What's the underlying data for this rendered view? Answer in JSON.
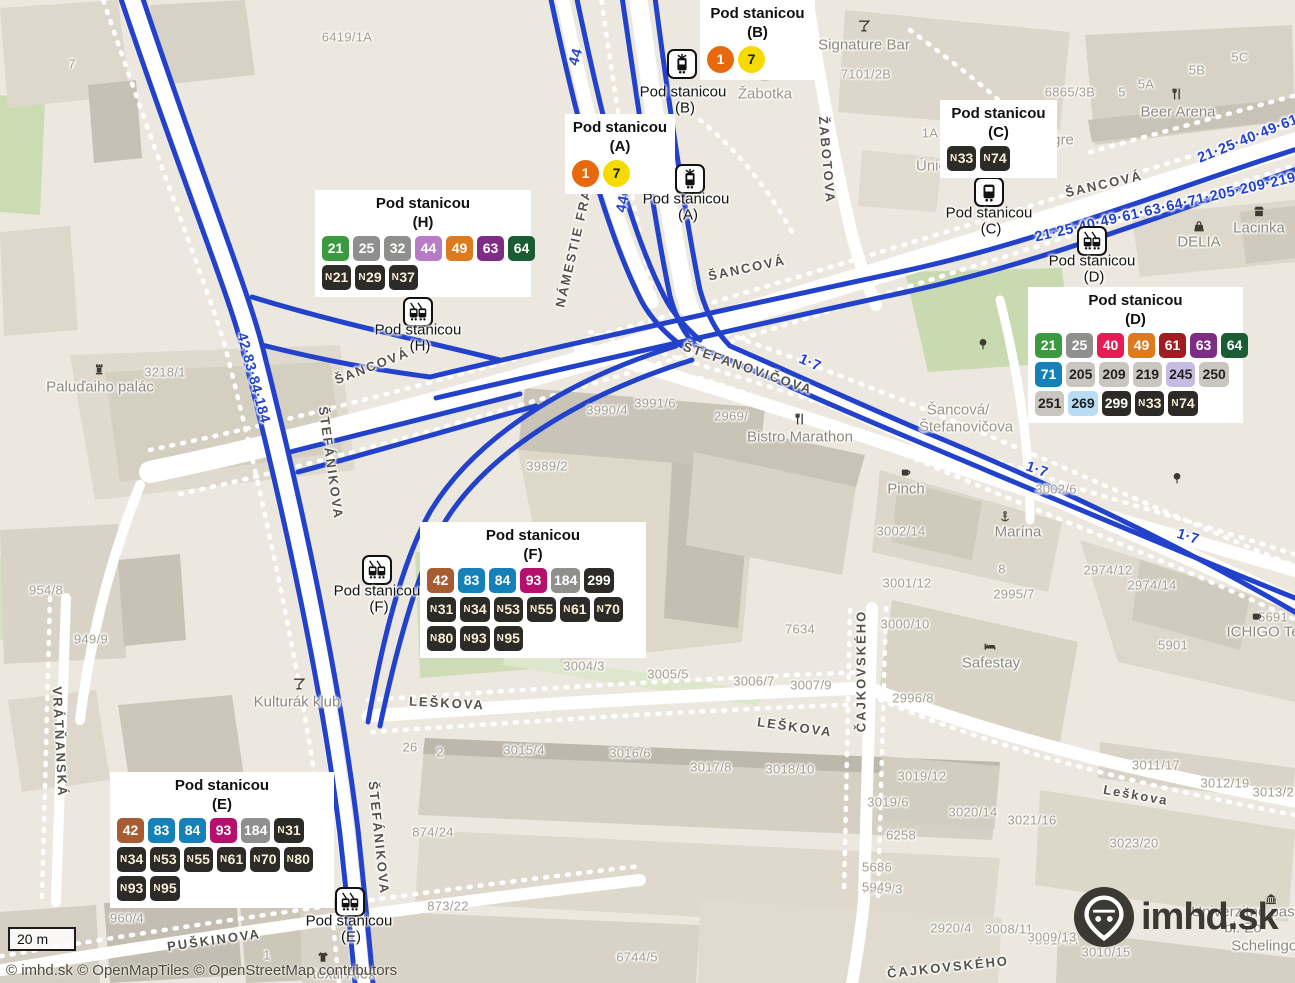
{
  "ui": {
    "scale_label": "20 m",
    "attribution": "© imhd.sk © OpenMapTiles © OpenStreetMap contributors",
    "logo_text": "imhd.sk"
  },
  "colors": {
    "route_line": "#2342cb",
    "map_bg": "#ece8df",
    "road": "#ffffff",
    "tram1": "#e8690b",
    "tram7": "#f7da00",
    "night_badge_bg": "#2c2b27",
    "night_badge_fg": "#f8eed6"
  },
  "streets": [
    [
      "ŠANCOVÁ",
      372,
      366,
      -21
    ],
    [
      "ŠANCOVÁ",
      747,
      268,
      -12
    ],
    [
      "ŠANCOVÁ",
      1104,
      184,
      -13
    ],
    [
      "ŠTEFÁNIKOVA",
      331,
      463,
      82
    ],
    [
      "ŠTEFÁNIKOVA",
      379,
      838,
      84
    ],
    [
      "ŠTEFANOVIČOVA",
      748,
      368,
      19
    ],
    [
      "NÁMESTIE FRANZA",
      577,
      232,
      -77
    ],
    [
      "ŽABOTOVA",
      827,
      160,
      85
    ],
    [
      "LEŠKOVA",
      447,
      703,
      3
    ],
    [
      "LEŠKOVA",
      795,
      727,
      8
    ],
    [
      "Leškova",
      1136,
      795,
      10
    ],
    [
      "PUŠKINOVA",
      214,
      940,
      -8
    ],
    [
      "ČAJKOVSKÉHO",
      861,
      671,
      -90
    ],
    [
      "ČAJKOVSKÉHO",
      948,
      967,
      -6
    ],
    [
      "VRÁTŇANSKÁ",
      60,
      742,
      87
    ]
  ],
  "house_numbers": [
    [
      "6419/1A",
      347,
      37
    ],
    [
      "7",
      72,
      64
    ],
    [
      "7101/2B",
      866,
      74
    ],
    [
      "6865/3B",
      1070,
      92
    ],
    [
      "1A",
      930,
      133
    ],
    [
      "5",
      1122,
      92
    ],
    [
      "5A",
      1146,
      84
    ],
    [
      "5B",
      1197,
      70
    ],
    [
      "5C",
      1240,
      57
    ],
    [
      "3218/1",
      165,
      372
    ],
    [
      "954/8",
      46,
      590
    ],
    [
      "949/9",
      91,
      639
    ],
    [
      "960/4",
      127,
      918
    ],
    [
      "3990/4",
      607,
      410
    ],
    [
      "3991/6",
      655,
      403
    ],
    [
      "3989/2",
      547,
      466
    ],
    [
      "2969/",
      731,
      416
    ],
    [
      "2995/7",
      1014,
      594
    ],
    [
      "3002/6",
      1056,
      489
    ],
    [
      "3002/14",
      901,
      531
    ],
    [
      "2974/12",
      1108,
      570
    ],
    [
      "2974/14",
      1152,
      585
    ],
    [
      "3001/12",
      907,
      583
    ],
    [
      "3000/10",
      905,
      624
    ],
    [
      "2996/8",
      913,
      698
    ],
    [
      "5901",
      1173,
      645
    ],
    [
      "8",
      1002,
      569
    ],
    [
      "5691",
      1273,
      617
    ],
    [
      "7634",
      800,
      629
    ],
    [
      "3004/3",
      584,
      666
    ],
    [
      "3005/5",
      668,
      674
    ],
    [
      "3006/7",
      754,
      681
    ],
    [
      "3007/9",
      811,
      685
    ],
    [
      "26",
      410,
      747
    ],
    [
      "2",
      440,
      752
    ],
    [
      "3015/4",
      524,
      750
    ],
    [
      "3016/6",
      630,
      753
    ],
    [
      "3017/8",
      711,
      767
    ],
    [
      "3018/10",
      790,
      769
    ],
    [
      "874/24",
      433,
      832
    ],
    [
      "873/22",
      448,
      906
    ],
    [
      "1",
      267,
      955
    ],
    [
      "7864/3",
      882,
      889
    ],
    [
      "2920/4",
      951,
      928
    ],
    [
      "7501/4A",
      1053,
      940
    ],
    [
      "6744/5",
      637,
      957
    ],
    [
      "6258",
      901,
      835
    ],
    [
      "5686",
      877,
      867
    ],
    [
      "5949",
      877,
      887
    ],
    [
      "3019/12",
      922,
      776
    ],
    [
      "3019/6",
      888,
      802
    ],
    [
      "3020/14",
      973,
      812
    ],
    [
      "3021/16",
      1032,
      820
    ],
    [
      "3023/20",
      1134,
      843
    ],
    [
      "3008/11",
      1009,
      929
    ],
    [
      "3009/13",
      1052,
      937
    ],
    [
      "3010/15",
      1106,
      952
    ],
    [
      "3011/17",
      1156,
      765
    ],
    [
      "3012/19",
      1225,
      783
    ],
    [
      "3013/21",
      1277,
      792
    ]
  ],
  "pois": [
    {
      "t": "Signature Bar",
      "x": 864,
      "y": 45,
      "icon": "cocktail-icon",
      "ix": 864,
      "iy": 28
    },
    {
      "t": "Žabotka",
      "x": 765,
      "y": 94,
      "icon": "shop-icon",
      "ix": 765,
      "iy": 77
    },
    {
      "t": "Beer Arena",
      "x": 1178,
      "y": 112,
      "icon": "restaurant-icon",
      "ix": 1177,
      "iy": 96
    },
    {
      "t": "DELIA",
      "x": 1199,
      "y": 242,
      "icon": "bag-icon",
      "ix": 1199,
      "iy": 228
    },
    {
      "t": "Lacinka",
      "x": 1259,
      "y": 228,
      "icon": "shop-icon",
      "ix": 1259,
      "iy": 213
    },
    {
      "t": "Bistro Marathon",
      "x": 800,
      "y": 437,
      "icon": "restaurant-icon",
      "ix": 800,
      "iy": 421
    },
    {
      "t": "Pinch",
      "x": 906,
      "y": 489,
      "icon": "cafe-icon",
      "ix": 906,
      "iy": 474
    },
    {
      "t": "Marína",
      "x": 1018,
      "y": 532,
      "icon": "anchor-icon",
      "ix": 1005,
      "iy": 519
    },
    {
      "t": "Safestay",
      "x": 991,
      "y": 663,
      "icon": "bed-icon",
      "ix": 990,
      "iy": 648
    },
    {
      "t": "ICHIGO Te",
      "x": 1263,
      "y": 632,
      "icon": "cafe-icon",
      "ix": 1257,
      "iy": 618
    },
    {
      "t": "Kulturák klub",
      "x": 297,
      "y": 702,
      "icon": "cocktail-icon",
      "ix": 299,
      "iy": 686
    },
    {
      "t": "Paluďaiho palác",
      "x": 100,
      "y": 387,
      "icon": "monument-icon",
      "ix": 99,
      "iy": 371
    },
    {
      "t": "textil Alex",
      "x": 344,
      "y": 974,
      "icon": "clothes-icon",
      "ix": 323,
      "iy": 959
    },
    {
      "t": "Univerzitné past",
      "x": 1245,
      "y": 912,
      "icon": null,
      "ix": 0,
      "iy": 0
    },
    {
      "t": "bl. Zo",
      "x": 1243,
      "y": 928,
      "icon": null,
      "ix": 0,
      "iy": 0
    },
    {
      "t": "Schelingov",
      "x": 1268,
      "y": 946,
      "icon": null,
      "ix": 0,
      "iy": 0
    },
    {
      "t": "gre",
      "x": 1063,
      "y": 140,
      "icon": null,
      "ix": 0,
      "iy": 0
    },
    {
      "t": "Únic",
      "x": 931,
      "y": 166,
      "icon": null,
      "ix": 0,
      "iy": 0
    },
    {
      "t": "Šancová/",
      "x": 958,
      "y": 410,
      "icon": null,
      "ix": 0,
      "iy": 0
    },
    {
      "t": "Štefanovičova",
      "x": 966,
      "y": 427,
      "icon": null,
      "ix": 0,
      "iy": 0
    },
    {
      "t": "",
      "x": 1271,
      "y": 901,
      "icon": "museum-icon",
      "ix": 1271,
      "iy": 901
    },
    {
      "t": "",
      "x": 983,
      "y": 346,
      "icon": "tree-icon",
      "ix": 983,
      "iy": 346
    },
    {
      "t": "",
      "x": 1177,
      "y": 480,
      "icon": "tree-icon",
      "ix": 1177,
      "iy": 480
    }
  ],
  "route_labels": [
    [
      "44",
      576,
      57,
      -73
    ],
    [
      "44",
      623,
      204,
      -79
    ],
    [
      "42·83·84·184",
      253,
      378,
      75
    ],
    [
      "21·25·40·49·61·63·64·71·205·209·219·",
      1168,
      207,
      -13
    ],
    [
      "21·25·40·49·61",
      1248,
      139,
      -22
    ],
    [
      "1·7",
      810,
      363,
      24
    ],
    [
      "1·7",
      1037,
      470,
      20
    ],
    [
      "1·7",
      1188,
      537,
      17
    ]
  ],
  "stops": [
    {
      "letter": "B",
      "icon": "tram-icon",
      "x": 682,
      "y": 64,
      "label": [
        "Pod stanicou",
        "(B)"
      ],
      "lx": 683,
      "ly": 92
    },
    {
      "letter": "A",
      "icon": "tram-icon",
      "x": 690,
      "y": 179,
      "label": [
        "Pod stanicou",
        "(A)"
      ],
      "lx": 686,
      "ly": 199
    },
    {
      "letter": "C",
      "icon": "bus-icon",
      "x": 989,
      "y": 192,
      "label": [
        "Pod stanicou",
        "(C)"
      ],
      "lx": 989,
      "ly": 213
    },
    {
      "letter": "H",
      "icon": "trolleybus-icon",
      "x": 418,
      "y": 312,
      "label": [
        "Pod stanicou",
        "(H)"
      ],
      "lx": 418,
      "ly": 330
    },
    {
      "letter": "D",
      "icon": "trolleybus-icon",
      "x": 1092,
      "y": 241,
      "label": [
        "Pod stanicou",
        "(D)"
      ],
      "lx": 1092,
      "ly": 261
    },
    {
      "letter": "F",
      "icon": "trolleybus-icon",
      "x": 377,
      "y": 570,
      "label": [
        "Pod stanicou",
        "(F)"
      ],
      "lx": 377,
      "ly": 591
    },
    {
      "letter": "E",
      "icon": "trolleybus-icon",
      "x": 350,
      "y": 902,
      "label": [
        "Pod stanicou",
        "(E)"
      ],
      "lx": 349,
      "ly": 921
    }
  ],
  "callouts": [
    {
      "letter": "(B)",
      "title": "Pod stanicou",
      "x": 700,
      "y": 0,
      "w": 115,
      "rows": [
        [
          [
            "1",
            "tram1"
          ],
          [
            "7",
            "tram7"
          ]
        ]
      ]
    },
    {
      "letter": "(A)",
      "title": "Pod stanicou",
      "x": 565,
      "y": 114,
      "w": 110,
      "rows": [
        [
          [
            "1",
            "tram1"
          ],
          [
            "7",
            "tram7"
          ]
        ]
      ]
    },
    {
      "letter": "(C)",
      "title": "Pod stanicou",
      "x": 940,
      "y": 100,
      "w": 117,
      "rows": [
        [
          [
            "N33",
            "night"
          ],
          [
            "N74",
            "night"
          ]
        ]
      ]
    },
    {
      "letter": "(H)",
      "title": "Pod stanicou",
      "x": 315,
      "y": 190,
      "w": 216,
      "rows": [
        [
          [
            "21",
            "green"
          ],
          [
            "25",
            "gray"
          ],
          [
            "32",
            "gray"
          ],
          [
            "44",
            "lilac"
          ],
          [
            "49",
            "orange"
          ],
          [
            "63",
            "purple"
          ],
          [
            "64",
            "dgreen"
          ]
        ],
        [
          [
            "N21",
            "night"
          ],
          [
            "N29",
            "night"
          ],
          [
            "N37",
            "night"
          ]
        ]
      ]
    },
    {
      "letter": "(D)",
      "title": "Pod stanicou",
      "x": 1028,
      "y": 287,
      "w": 215,
      "rows": [
        [
          [
            "21",
            "green"
          ],
          [
            "25",
            "gray"
          ],
          [
            "40",
            "pink"
          ],
          [
            "49",
            "orange"
          ],
          [
            "61",
            "dred"
          ],
          [
            "63",
            "purple"
          ],
          [
            "64",
            "dgreen"
          ]
        ],
        [
          [
            "71",
            "blue"
          ],
          [
            "205",
            "lgray"
          ],
          [
            "209",
            "lgray"
          ],
          [
            "219",
            "lgray"
          ],
          [
            "245",
            "lavender"
          ],
          [
            "250",
            "lgray"
          ]
        ],
        [
          [
            "251",
            "lgray"
          ],
          [
            "269",
            "lblue"
          ],
          [
            "299",
            "black"
          ],
          [
            "N33",
            "night"
          ],
          [
            "N74",
            "night"
          ]
        ]
      ]
    },
    {
      "letter": "(F)",
      "title": "Pod stanicou",
      "x": 420,
      "y": 522,
      "w": 226,
      "rows": [
        [
          [
            "42",
            "brown"
          ],
          [
            "83",
            "blue"
          ],
          [
            "84",
            "blue"
          ],
          [
            "93",
            "magenta"
          ],
          [
            "184",
            "gray"
          ],
          [
            "299",
            "black"
          ]
        ],
        [
          [
            "N31",
            "night"
          ],
          [
            "N34",
            "night"
          ],
          [
            "N53",
            "night"
          ],
          [
            "N55",
            "night"
          ],
          [
            "N61",
            "night"
          ],
          [
            "N70",
            "night"
          ]
        ],
        [
          [
            "N80",
            "night"
          ],
          [
            "N93",
            "night"
          ],
          [
            "N95",
            "night"
          ]
        ]
      ]
    },
    {
      "letter": "(E)",
      "title": "Pod stanicou",
      "x": 110,
      "y": 772,
      "w": 224,
      "rows": [
        [
          [
            "42",
            "brown"
          ],
          [
            "83",
            "blue"
          ],
          [
            "84",
            "blue"
          ],
          [
            "93",
            "magenta"
          ],
          [
            "184",
            "gray"
          ],
          [
            "N31",
            "night"
          ]
        ],
        [
          [
            "N34",
            "night"
          ],
          [
            "N53",
            "night"
          ],
          [
            "N55",
            "night"
          ],
          [
            "N61",
            "night"
          ],
          [
            "N70",
            "night"
          ],
          [
            "N80",
            "night"
          ]
        ],
        [
          [
            "N93",
            "night"
          ],
          [
            "N95",
            "night"
          ]
        ]
      ]
    }
  ]
}
